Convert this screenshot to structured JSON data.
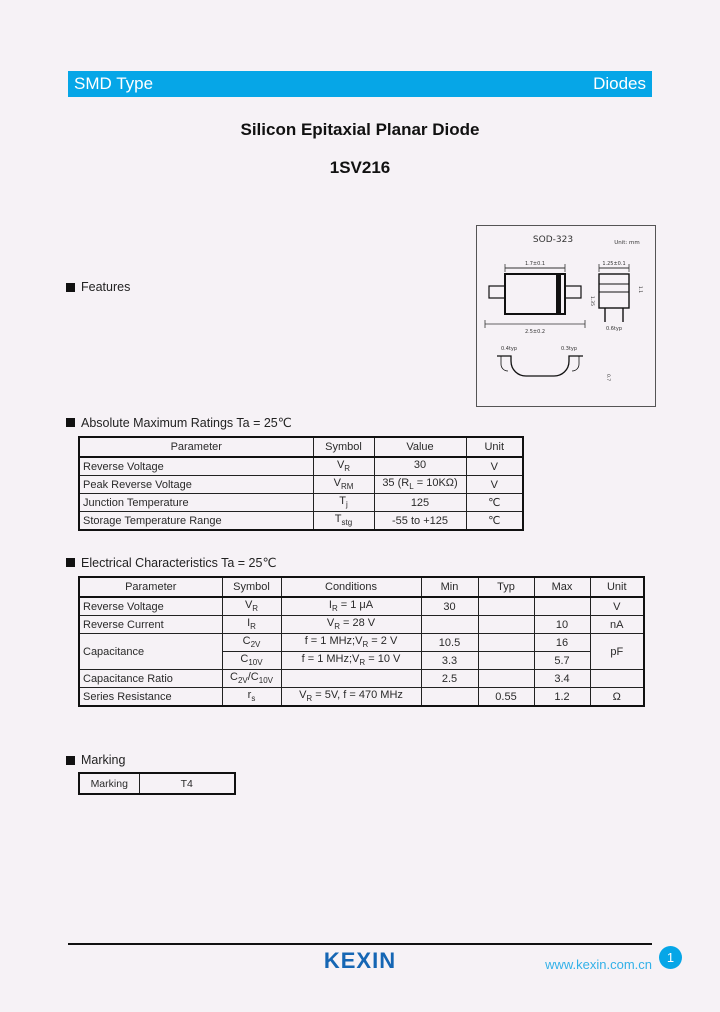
{
  "colors": {
    "accent": "#06a6e7",
    "logo_blue": "#1566b4",
    "link": "#33b1e8"
  },
  "header": {
    "left": "SMD Type",
    "right": "Diodes"
  },
  "title": {
    "line1": "Silicon Epitaxial Planar Diode",
    "line2": "1SV216"
  },
  "package_drawing": {
    "name": "SOD-323",
    "unit": "Unit: mm",
    "dims": {
      "front_top": "1.7±0.1",
      "front_bottom": "2.5±0.2",
      "front_height": "1.35",
      "side_top": "1.25±0.1",
      "side_bottom": "0.6typ",
      "side_height": "1.1",
      "bottom_left": "0.4typ",
      "bottom_right": "0.3typ",
      "bottom_height": "0.7"
    }
  },
  "sections": {
    "features": "Features",
    "abs": "Absolute Maximum Ratings Ta = 25℃",
    "elec": "Electrical Characteristics Ta = 25℃",
    "marking": "Marking"
  },
  "abs_table": {
    "headers": [
      "Parameter",
      "Symbol",
      "Value",
      "Unit"
    ],
    "rows": [
      {
        "param": "Reverse Voltage",
        "sym": {
          "p1": "V",
          "s1": "R"
        },
        "val": {
          "p1": "30"
        },
        "unit": "V"
      },
      {
        "param": "Peak Reverse Voltage",
        "sym": {
          "p1": "V",
          "s1": "RM"
        },
        "val": {
          "p1": "35 (R",
          "s1": "L",
          "p2": " = 10KΩ)"
        },
        "unit": "V"
      },
      {
        "param": "Junction Temperature",
        "sym": {
          "p1": "T",
          "s1": "j"
        },
        "val": {
          "p1": "125"
        },
        "unit": "℃"
      },
      {
        "param": "Storage Temperature Range",
        "sym": {
          "p1": "T",
          "s1": "stg"
        },
        "val": {
          "p1": "-55 to +125"
        },
        "unit": "℃"
      }
    ]
  },
  "elec_table": {
    "headers": [
      "Parameter",
      "Symbol",
      "Conditions",
      "Min",
      "Typ",
      "Max",
      "Unit"
    ],
    "rows": [
      {
        "param": "Reverse Voltage",
        "sym": {
          "p1": "I... ",
          "s1": ""
        },
        "min": "30",
        "typ": "",
        "max": "",
        "unit": "V"
      },
      {
        "param": "Reverse Current",
        "min": "",
        "typ": "",
        "max": "10",
        "unit": "nA"
      },
      {
        "param": "Capacitance",
        "min": "10.5",
        "typ": "",
        "max": "16",
        "unit": "pF"
      },
      {
        "min": "3.3",
        "typ": "",
        "max": "5.7"
      },
      {
        "param": "Capacitance Ratio",
        "min": "2.5",
        "typ": "",
        "max": "3.4",
        "unit": ""
      },
      {
        "param": "Series Resistance",
        "min": "",
        "typ": "0.55",
        "max": "1.2",
        "unit": "Ω"
      }
    ],
    "syms": [
      {
        "p1": "V",
        "s1": "R"
      },
      {
        "p1": "I",
        "s1": "R"
      },
      {
        "p1": "C",
        "s1": "2V"
      },
      {
        "p1": "C",
        "s1": "10V"
      },
      {
        "p1": "C",
        "s1": "2V",
        "p2": "/C",
        "s2": "10V"
      },
      {
        "p1": "r",
        "s1": "s"
      }
    ],
    "conds": [
      {
        "p1": "I",
        "s1": "R",
        "p2": " = 1 μA"
      },
      {
        "p1": "V",
        "s1": "R",
        "p2": " = 28 V"
      },
      {
        "p1": "f = 1 MHz;V",
        "s1": "R",
        "p2": " = 2 V"
      },
      {
        "p1": "f = 1 MHz;V",
        "s1": "R",
        "p2": " = 10 V"
      },
      {
        "p1": ""
      },
      {
        "p1": "V",
        "s1": "R",
        "p2": " = 5V, f = 470 MHz"
      }
    ]
  },
  "marking_table": {
    "label": "Marking",
    "value": "T4"
  },
  "footer": {
    "logo": "KEXIN",
    "url": "www.kexin.com.cn",
    "page": "1"
  }
}
